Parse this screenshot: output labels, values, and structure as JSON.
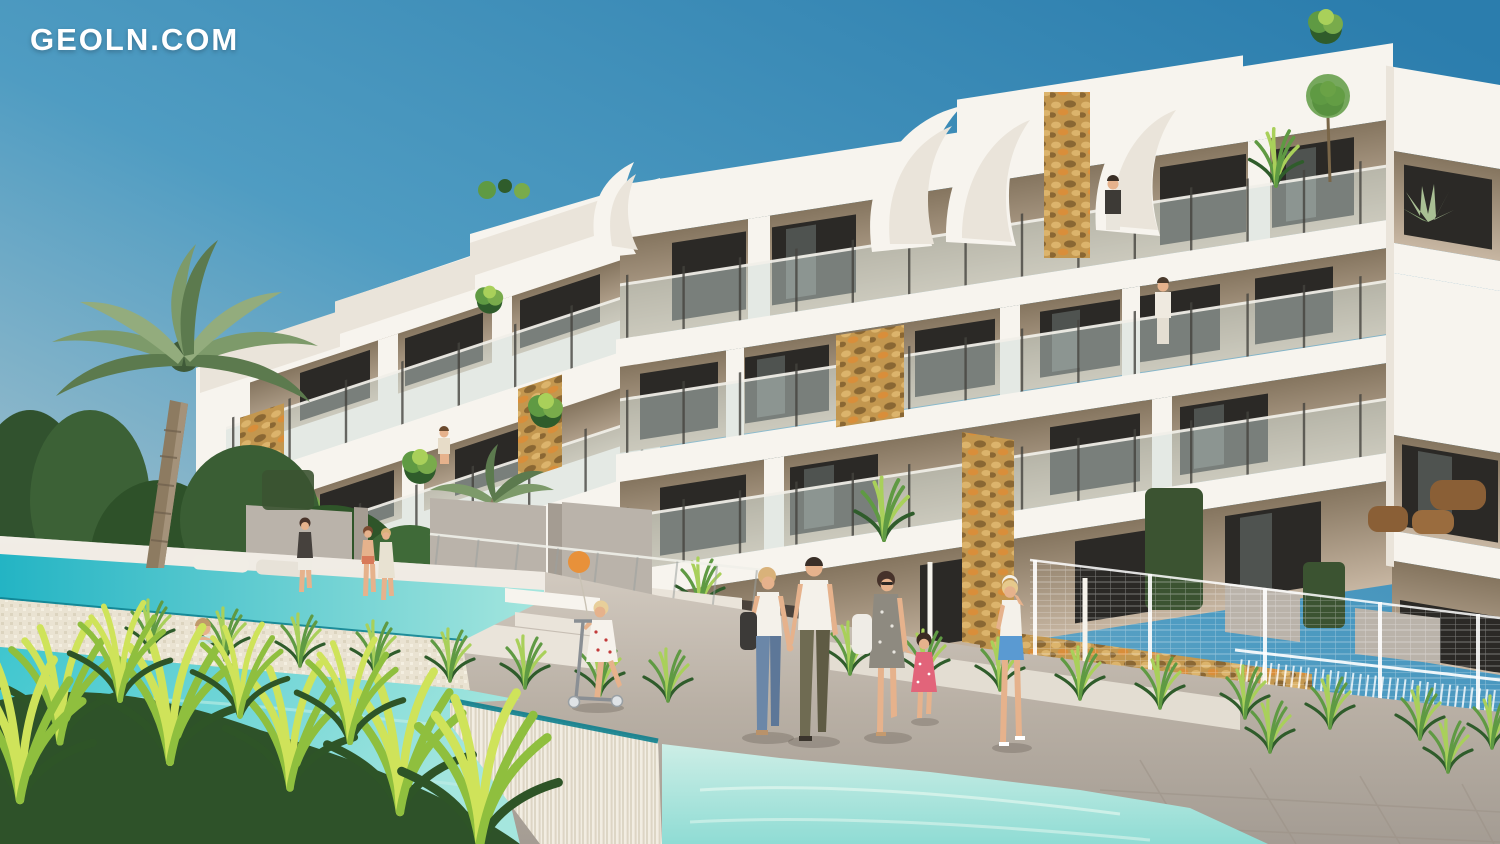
{
  "watermark": {
    "text": "GEOLN.COM"
  },
  "palette": {
    "sky_top": "#2b7dad",
    "sky_mid": "#4f9cc2",
    "sky_horizon": "#c6d1d2",
    "white_hi": "#f7f4ee",
    "white_shade": "#eae4da",
    "white_deep": "#d7cfc3",
    "recess_dark": "#85755f",
    "recess_light": "#c7b6a2",
    "window_dark": "#2b2926",
    "glass_tint": "#cfdeda",
    "stone_light": "#dcb46c",
    "stone_mid": "#c3974f",
    "stone_dark": "#8a6733",
    "stone_orange": "#d98e3a",
    "screen_grey": "#bab3aa",
    "screen_dark": "#a49c92",
    "hedge": "#3b5331",
    "leaf_dark": "#2f5c2b",
    "leaf_mid": "#5f9a43",
    "leaf_light": "#a9d05a",
    "leaf_yellow": "#cfe35a",
    "palm_leaf": "#7d9a6a",
    "palm_leaf_dark": "#5c7a4e",
    "palm_trunk": "#8d7b61",
    "water_deep": "#23b4c4",
    "water_main": "#3fc6cf",
    "water_light": "#a5e6de",
    "water_pale": "#cdeee6",
    "pool_edge": "#0e7f8e",
    "mosaic": "#eae3d2",
    "cascade_a": "#f2ede2",
    "cascade_b": "#ddd5c4",
    "path_light": "#d8d0c6",
    "path_mid": "#b9b0a5",
    "path_dark": "#a49c93",
    "skin": "#e6b28c",
    "jeans_blue": "#6b87a8",
    "olive_pants": "#6f6b52",
    "dress_pink": "#e2647a",
    "shorts_blue": "#5a9ad2",
    "balloon_orange": "#e8913a"
  },
  "scene": {
    "type": "architectural-exterior-render",
    "elements": [
      "sky",
      "terraced-apartment-building",
      "rooftop-sail-sculptures",
      "stone-gabion-accents",
      "palm-tree",
      "garden-shrubs",
      "ornamental-grasses",
      "privacy-screens",
      "stone-wall",
      "wire-fence",
      "upper-pool",
      "infinity-pool",
      "cascade-wall",
      "pool-deck-path",
      "walking-people",
      "balcony-residents",
      "watermark-logo"
    ]
  }
}
